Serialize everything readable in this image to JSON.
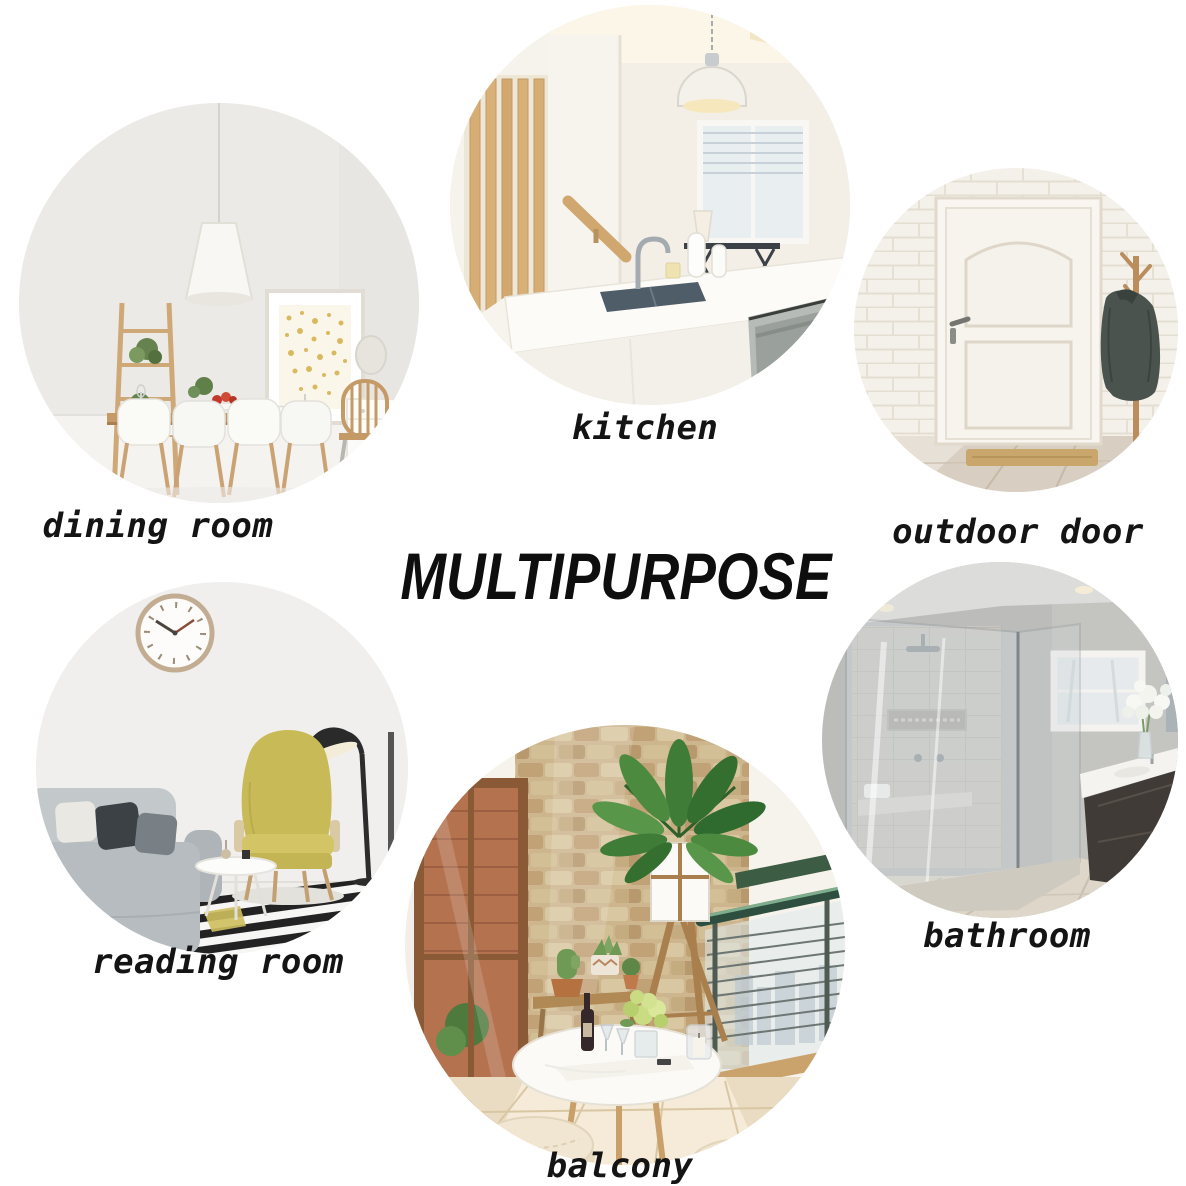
{
  "title": "MULTIPURPOSE",
  "sections": [
    {
      "id": "dining-room",
      "label": "dining room"
    },
    {
      "id": "kitchen",
      "label": "kitchen"
    },
    {
      "id": "outdoor-door",
      "label": "outdoor door"
    },
    {
      "id": "reading-room",
      "label": "reading room"
    },
    {
      "id": "bathroom",
      "label": "bathroom"
    },
    {
      "id": "balcony",
      "label": "balcony"
    }
  ],
  "colors": {
    "background": "#ffffff",
    "text": "#141414"
  }
}
